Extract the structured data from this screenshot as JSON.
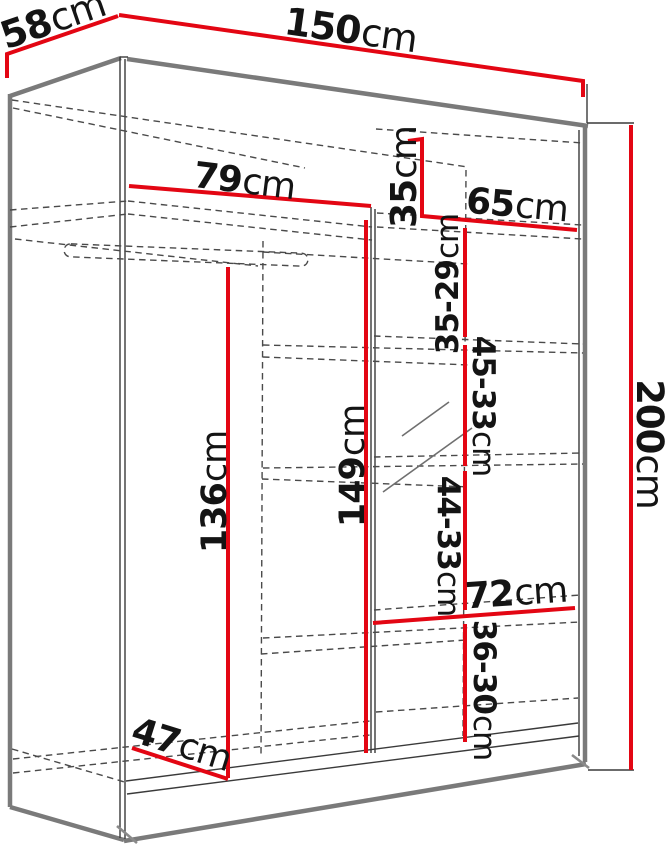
{
  "diagram": {
    "type": "wardrobe-dimension-drawing",
    "unit": "cm",
    "colors": {
      "dimension_line": "#e30613",
      "outline": "#7a7a7a",
      "hidden_edge": "#4a4a4a",
      "label_text": "#141414",
      "background": "#ffffff"
    },
    "labels": {
      "depth": {
        "v": "58",
        "u": "cm"
      },
      "width": {
        "v": "150",
        "u": "cm"
      },
      "height": {
        "v": "200",
        "u": "cm"
      },
      "left_shelf_width": {
        "v": "79",
        "u": "cm"
      },
      "top_shelf_height": {
        "v": "35",
        "u": "cm"
      },
      "right_shelf_width": {
        "v": "65",
        "u": "cm"
      },
      "shelf_gap_1": {
        "v": "35-29",
        "u": "cm"
      },
      "shelf_gap_2": {
        "v": "45-33",
        "u": "cm"
      },
      "interior_height": {
        "v": "149",
        "u": "cm"
      },
      "hanging_height": {
        "v": "136",
        "u": "cm"
      },
      "shelf_gap_3": {
        "v": "44-33",
        "u": "cm"
      },
      "bottom_shelf_width": {
        "v": "72",
        "u": "cm"
      },
      "shelf_gap_4": {
        "v": "36-30",
        "u": "cm"
      },
      "bottom_left_width": {
        "v": "47",
        "u": "cm"
      }
    }
  }
}
